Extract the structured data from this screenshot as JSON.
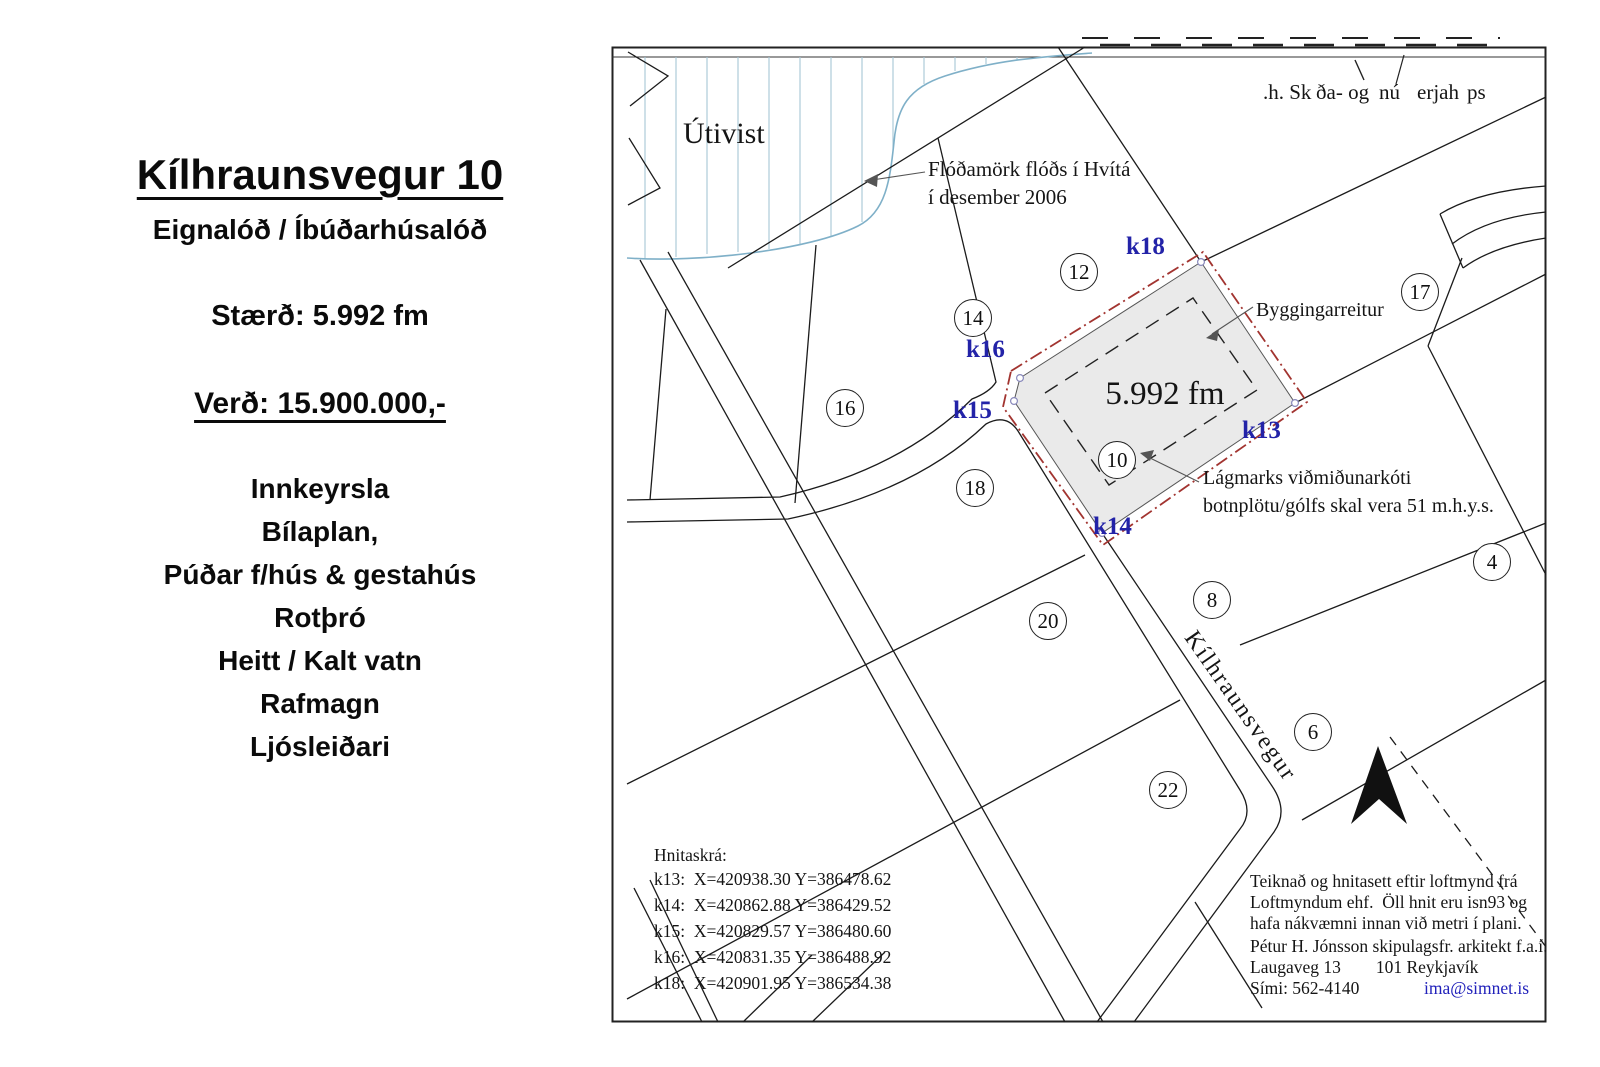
{
  "colors": {
    "line": "#1b1b1b",
    "k_label": "#2323a8",
    "flood_line": "#7fb0c8",
    "hatch": "#a5c6d6",
    "plot_fill": "#eaeaea",
    "plot_outline_red": "#a23430",
    "email": "#2222bb"
  },
  "left_panel": {
    "title": "Kílhraunsvegur 10",
    "subtitle": "Eignalóð / Íbúðarhúsalóð",
    "size": "Stærð: 5.992 fm",
    "price": "Verð: 15.900.000,-",
    "features": [
      "Innkeyrsla",
      "Bílaplan,",
      "Púðar f/hús & gestahús",
      "Rotþró",
      "Heitt / Kalt vatn",
      "Rafmagn",
      "Ljósleiðari"
    ]
  },
  "map": {
    "header_fragments": [
      ".h. Sk",
      "ða- og",
      "nú",
      "erjah",
      "ps"
    ],
    "area_label": "Útivist",
    "flood_note": {
      "line1": "Flóðamörk flóðs í Hvítá",
      "line2": "í desember 2006"
    },
    "building_area_label": "Byggingarreitur",
    "plot_size": "5.992 fm",
    "min_level": {
      "line1": "Lágmarks viðmiðunarkóti",
      "line2": "botnplötu/gólfs skal vera 51 m.h.y.s."
    },
    "street_name": "Kílhraunsvegur",
    "lots": [
      "12",
      "14",
      "16",
      "18",
      "10",
      "20",
      "8",
      "22",
      "6",
      "17",
      "4"
    ],
    "k_points": [
      "k18",
      "k16",
      "k15",
      "k13",
      "k14"
    ],
    "coords": {
      "title": "Hnitaskrá:",
      "entries": [
        "k13:  X=420938.30 Y=386478.62",
        "k14:  X=420862.88 Y=386429.52",
        "k15:  X=420829.57 Y=386480.60",
        "k16:  X=420831.35 Y=386488.92",
        "k18:  X=420901.95 Y=386534.38"
      ]
    },
    "credits": {
      "l1": "Teiknað og hnitasett eftir loftmynd frá",
      "l2": "Loftmyndum ehf.  Öll hnit eru isn93 og",
      "l3": "hafa nákvæmni innan við metri í plani.",
      "l4": "Pétur H. Jónsson skipulagsfr. arkitekt f.a.í.",
      "l5": "Laugaveg 13        101 Reykjavík",
      "phone": "Sími: 562-4140",
      "email": "ima@simnet.is"
    }
  }
}
